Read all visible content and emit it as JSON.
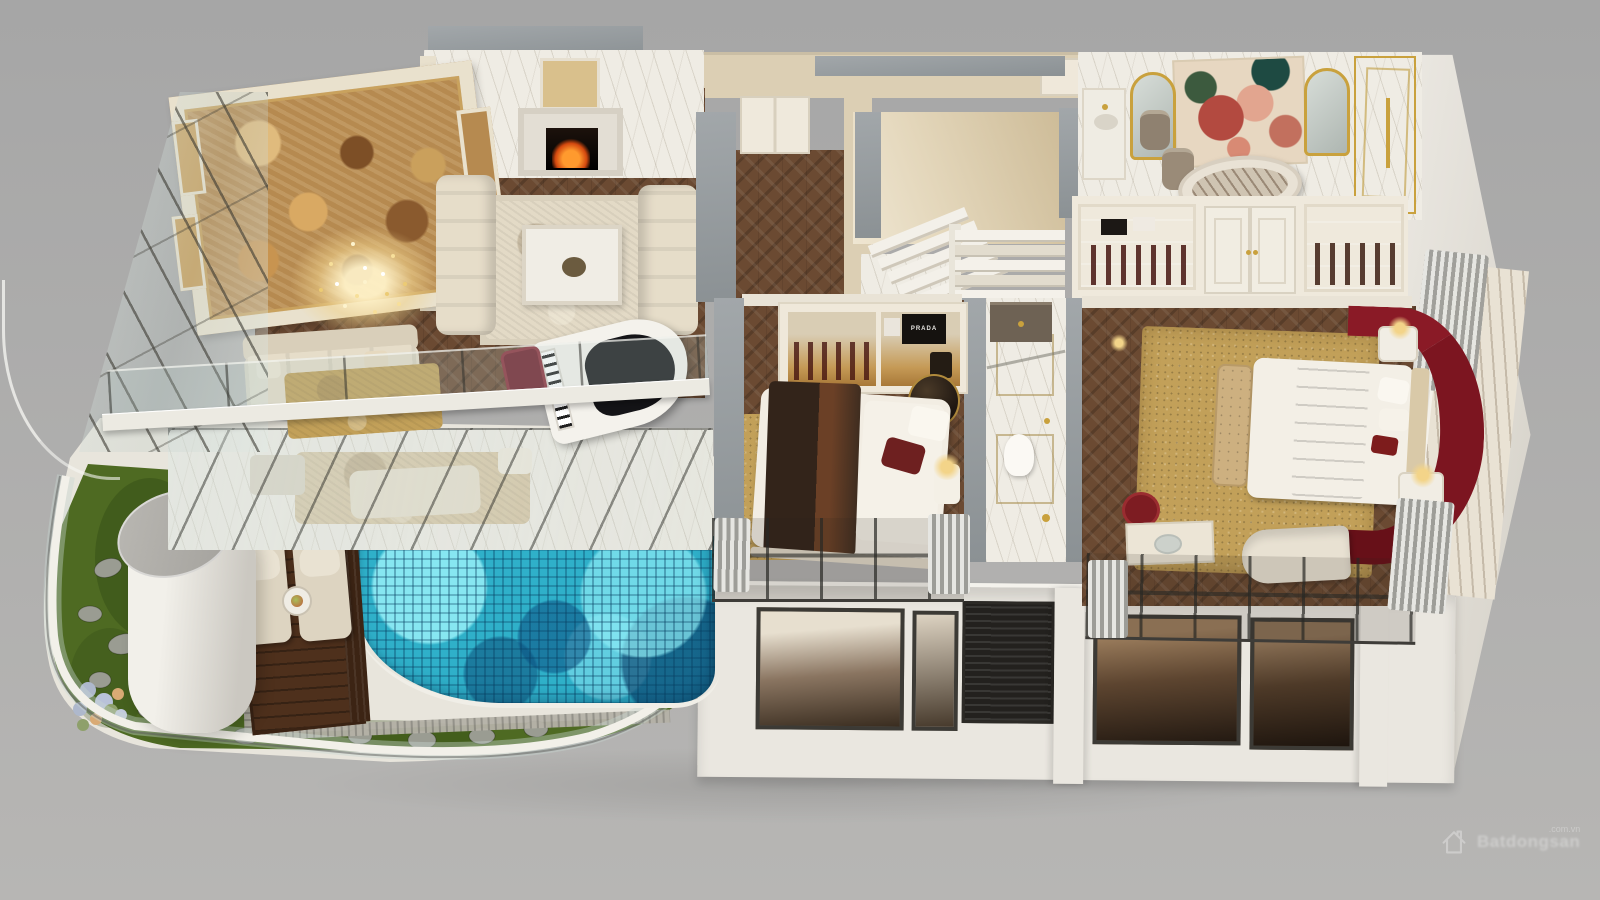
{
  "watermark": {
    "brand": "Batdongsan",
    "suffix": ".com.vn",
    "icon": "house-outline-icon"
  },
  "labels": {
    "prada_box": "PRADA"
  },
  "palette": {
    "bg_top": "#a6a6a6",
    "bg_bottom": "#b7b6b4",
    "cut_wall": "#a2a7aa",
    "terrace": "#e8e5dc",
    "wall_cream": "#efe8da",
    "wall_beige": "#dccfb4",
    "marble": "#efece4",
    "wood": "#6b4a32",
    "wood_dark": "#573a26",
    "ceiling_amber": "#b68a50",
    "rug_cream": "#e3dac6",
    "rug_gold": "#c2a059",
    "sofa_cream": "#e6ddc9",
    "pool_base": "#2fb0c9",
    "pool_light": "#8fe3ee",
    "pool_dark": "#0b6a9a",
    "deck": "#4e301c",
    "grass": "#4e6a22",
    "grass_dark": "#2c4312",
    "stone": "#9a9c92",
    "burgundy": "#7c1520",
    "gold": "#c9a13d",
    "facade": "#eae7e0",
    "window_frame": "#3c3a35",
    "louver": "#23211e",
    "fire": "#ff9a2e",
    "mural_bg": "#e7d7c1",
    "mural_red": "#b34a40",
    "mural_pink": "#e2a58f",
    "mural_leaf": "#3c5a3e",
    "column_gray": "#b4b2ad",
    "step_white": "#f3f0e9"
  }
}
